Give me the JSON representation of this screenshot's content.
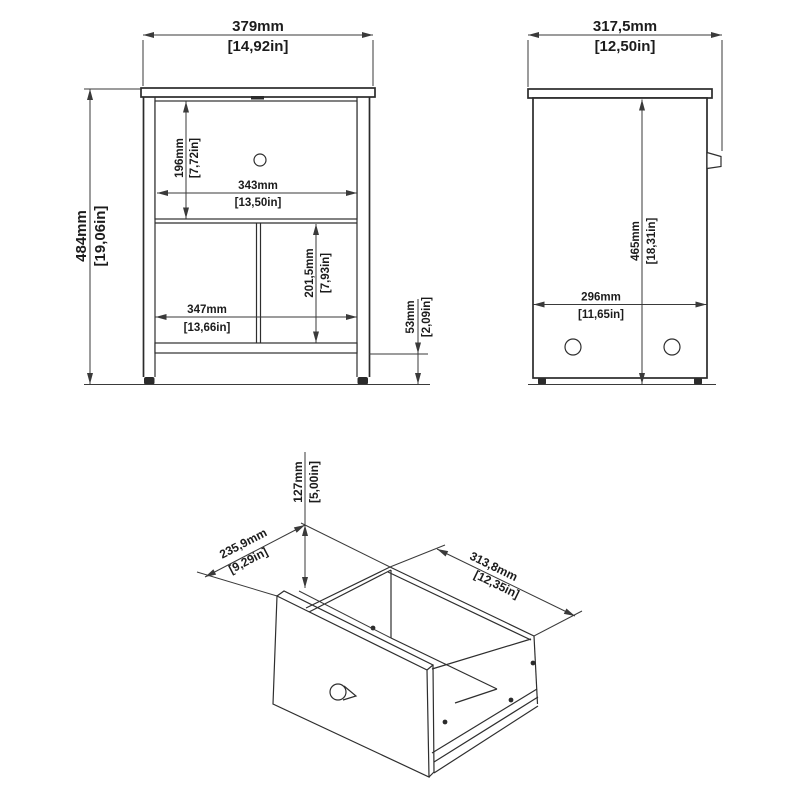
{
  "drawing": {
    "title": "nightstand-dimension-drawing",
    "line_color": "#2b2b2b",
    "background": "#ffffff"
  },
  "front_view": {
    "width_mm": "379mm",
    "width_in": "[14,92in]",
    "height_mm": "484mm",
    "height_in": "[19,06in]",
    "drawer_h_mm": "196mm",
    "drawer_h_in": "[7,72in]",
    "drawer_w_mm": "343mm",
    "drawer_w_in": "[13,50in]",
    "open_h_mm": "201,5mm",
    "open_h_in": "[7,93in]",
    "open_w_mm": "347mm",
    "open_w_in": "[13,66in]",
    "plinth_mm": "53mm",
    "plinth_in": "[2,09in]"
  },
  "side_view": {
    "depth_mm": "317,5mm",
    "depth_in": "[12,50in]",
    "height_mm": "465mm",
    "height_in": "[18,31in]",
    "base_depth_mm": "296mm",
    "base_depth_in": "[11,65in]"
  },
  "drawer_view": {
    "height_mm": "127mm",
    "height_in": "[5,00in]",
    "depth_mm": "235,9mm",
    "depth_in": "[9,29in]",
    "width_mm": "313,8mm",
    "width_in": "[12,35in]"
  }
}
